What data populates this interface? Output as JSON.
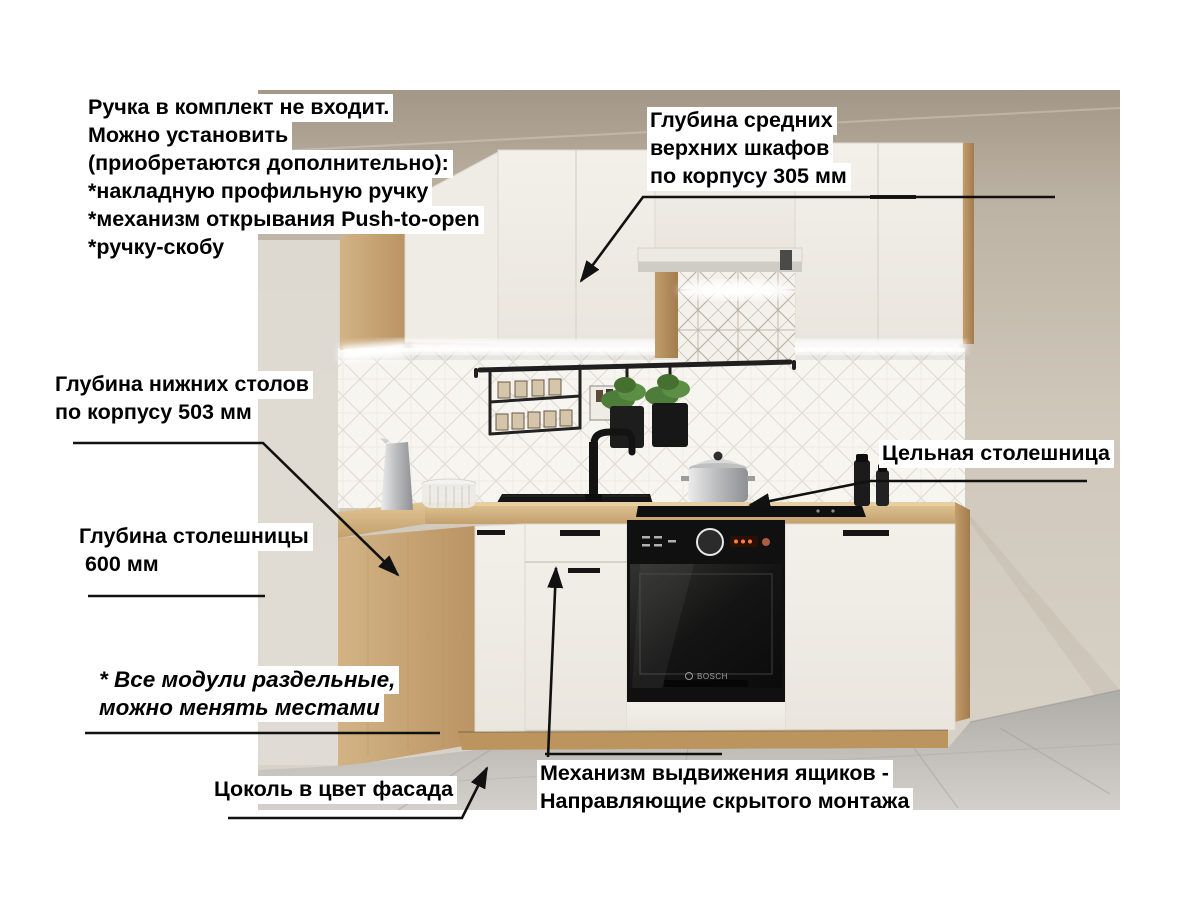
{
  "annotations": {
    "handle_note": {
      "lines": [
        "Ручка в комплект не входит.",
        "Можно установить",
        "(приобретаются дополнительно):",
        "*накладную профильную ручку",
        "*механизм открывания Push-to-open",
        "*ручку-скобу"
      ]
    },
    "upper_depth": {
      "lines": [
        "Глубина средних",
        "верхних шкафов",
        "по корпусу 305 мм"
      ]
    },
    "base_depth": {
      "lines": [
        "Глубина нижних столов",
        "по корпусу 503 мм"
      ]
    },
    "countertop_depth": {
      "lines": [
        "Глубина столешницы",
        " 600 мм"
      ]
    },
    "solid_countertop": {
      "lines": [
        "Цельная столешница"
      ]
    },
    "modules_note": {
      "lines": [
        "* Все модули раздельные,",
        "можно менять местами"
      ]
    },
    "plinth_note": {
      "lines": [
        "Цоколь в цвет фасада"
      ]
    },
    "drawer_note": {
      "lines": [
        "Механизм выдвижения ящиков -",
        "Направляющие скрытого монтажа"
      ]
    }
  },
  "scene": {
    "oven_brand": "BOSCH",
    "colors": {
      "wall": "#c7beb1",
      "wood": "#c9a877",
      "counter": "#d4b384",
      "cabinet_front": "#f1eee8",
      "backsplash": "#f6f4f0",
      "oven": "#1a1a1a",
      "floor": "#c4c1bc",
      "arrow": "#111111",
      "label_bg": "#ffffff",
      "label_text": "#000000"
    }
  }
}
